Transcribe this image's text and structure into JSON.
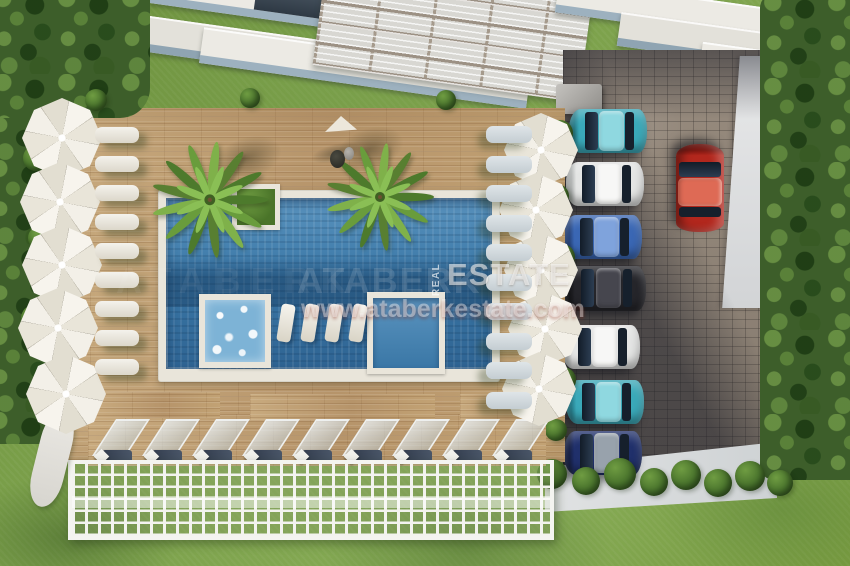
{
  "watermark": {
    "brand_ghost": "ATABERK",
    "real_label": "REAL",
    "estate_label": "ESTATE",
    "url": "www.ataberkestate.com"
  },
  "palette": {
    "pool_water": "#3d7cab",
    "deck_wood": "#c2a176",
    "grass": "#7da24c",
    "umbrella_canvas": "#f3f0e8",
    "paver": "#8d8175",
    "trellis_white": "#f3f3ef"
  },
  "scene": {
    "umbrellas": {
      "radius_left": 40,
      "radius_right": 37,
      "left": [
        {
          "x": 62,
          "y": 138
        },
        {
          "x": 60,
          "y": 202
        },
        {
          "x": 62,
          "y": 265
        },
        {
          "x": 58,
          "y": 328
        },
        {
          "x": 66,
          "y": 394
        }
      ],
      "right": [
        {
          "x": 541,
          "y": 150
        },
        {
          "x": 536,
          "y": 210
        },
        {
          "x": 541,
          "y": 270
        },
        {
          "x": 545,
          "y": 329
        },
        {
          "x": 539,
          "y": 389
        }
      ]
    },
    "loungers": {
      "left_x": 95,
      "left_start_y": 127,
      "left_step": 29,
      "left_count": 9,
      "right_x": 486,
      "right_start_y": 126,
      "right_step": 29.5,
      "right_count": 10
    },
    "pool_loungers": {
      "count": 4,
      "start_x": 279,
      "step": 24,
      "y": 304
    },
    "canopy_row": {
      "count": 9,
      "start_x": 94,
      "step": 50,
      "y": 419
    },
    "palms": [
      {
        "x": 210,
        "y": 200,
        "scale": 1.08,
        "sdx": 38,
        "sdy": -42
      },
      {
        "x": 380,
        "y": 197,
        "scale": 1.0,
        "sdx": -10,
        "sdy": -48
      }
    ],
    "cars": [
      {
        "name": "car-teal-1",
        "cx": 608,
        "cy": 131,
        "rot": 0,
        "len": 78,
        "wid": 44,
        "body": "#3aa9b9",
        "roof": "#8fd8e0",
        "nose": "#23808f"
      },
      {
        "name": "car-white-1",
        "cx": 605,
        "cy": 184,
        "rot": 0,
        "len": 78,
        "wid": 44,
        "body": "#e4e5e4",
        "roof": "#f7f7f6",
        "nose": "#b7bab9"
      },
      {
        "name": "car-blue",
        "cx": 603,
        "cy": 237,
        "rot": 0,
        "len": 78,
        "wid": 44,
        "body": "#3a67b4",
        "roof": "#7fa3dc",
        "nose": "#24437e"
      },
      {
        "name": "car-black",
        "cx": 605,
        "cy": 288,
        "rot": 0,
        "len": 82,
        "wid": 45,
        "body": "#25252a",
        "roof": "#46464e",
        "nose": "#121215"
      },
      {
        "name": "car-white-2",
        "cx": 601,
        "cy": 347,
        "rot": 0,
        "len": 78,
        "wid": 44,
        "body": "#e4e5e4",
        "roof": "#f7f7f6",
        "nose": "#b7bab9"
      },
      {
        "name": "car-teal-2",
        "cx": 605,
        "cy": 402,
        "rot": 0,
        "len": 78,
        "wid": 44,
        "body": "#3aa9b9",
        "roof": "#8fd8e0",
        "nose": "#23808f"
      },
      {
        "name": "car-navy",
        "cx": 603,
        "cy": 453,
        "rot": 0,
        "len": 78,
        "wid": 44,
        "body": "#20306b",
        "roof": "#98a2ac",
        "nose": "#131c42"
      },
      {
        "name": "car-red",
        "cx": 700,
        "cy": 188,
        "rot": 90,
        "len": 88,
        "wid": 48,
        "body": "#b2271d",
        "roof": "#de6a55",
        "nose": "#7c150f"
      }
    ],
    "bushes": [
      {
        "x": 560,
        "y": 133,
        "s": 26
      },
      {
        "x": 557,
        "y": 196,
        "s": 24
      },
      {
        "x": 562,
        "y": 257,
        "s": 26
      },
      {
        "x": 558,
        "y": 318,
        "s": 24
      },
      {
        "x": 563,
        "y": 380,
        "s": 26
      },
      {
        "x": 556,
        "y": 430,
        "s": 22
      },
      {
        "x": 36,
        "y": 158,
        "s": 26
      },
      {
        "x": 40,
        "y": 238,
        "s": 24
      },
      {
        "x": 34,
        "y": 318,
        "s": 26
      },
      {
        "x": 42,
        "y": 392,
        "s": 22
      },
      {
        "x": 96,
        "y": 100,
        "s": 22
      },
      {
        "x": 250,
        "y": 98,
        "s": 20
      },
      {
        "x": 446,
        "y": 100,
        "s": 20
      }
    ],
    "hedge_bottom": [
      {
        "x": 552,
        "y": 474,
        "s": 30
      },
      {
        "x": 586,
        "y": 481,
        "s": 28
      },
      {
        "x": 620,
        "y": 474,
        "s": 32
      },
      {
        "x": 654,
        "y": 482,
        "s": 28
      },
      {
        "x": 686,
        "y": 475,
        "s": 30
      },
      {
        "x": 718,
        "y": 483,
        "s": 28
      },
      {
        "x": 750,
        "y": 476,
        "s": 30
      },
      {
        "x": 780,
        "y": 483,
        "s": 26
      }
    ],
    "palm_frond_colors": [
      "#4d7a2c",
      "#699c3c",
      "#7fb14a",
      "#587f31"
    ]
  }
}
